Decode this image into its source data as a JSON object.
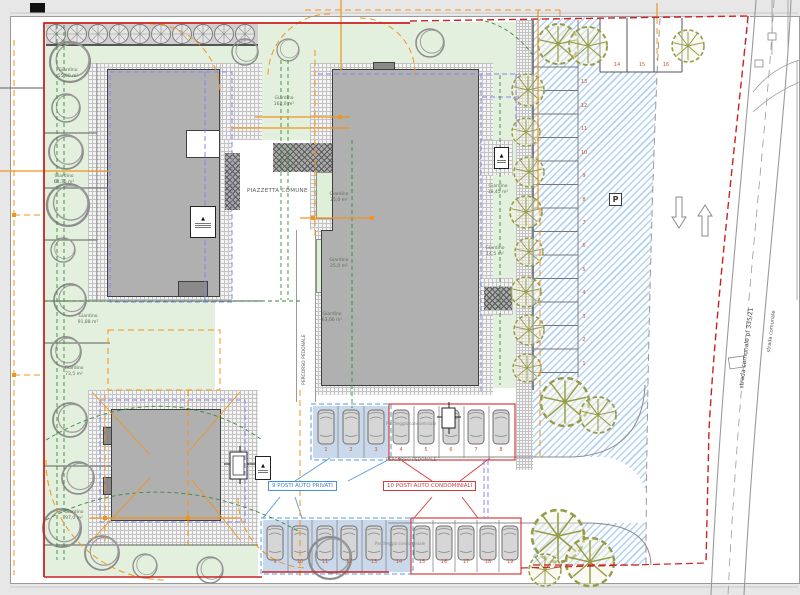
{
  "labels": {
    "piazzetta": "PIAZZETTA COMUNE",
    "percorso_pedonale_vertical": "PERCORSO PEDONALE",
    "percorso_pedonale_horizontal": "PERCORSO PEDONALE",
    "parcheggio_condominiale_mid": "Parcheggio condominiale",
    "parcheggio_condominiale_bottom": "Parcheggio condominiale",
    "posti_privati": "9 POSTI AUTO PRIVATI",
    "posti_condominiali": "10 POSTI AUTO CONDOMINIALI",
    "street_name": "strada comunale pf 335/21",
    "street_name_2": "strada comunale",
    "parking_sign": "P"
  },
  "gardens": {
    "g1": {
      "name": "Giardino",
      "area": "55,00 m²"
    },
    "g2": {
      "name": "Giardino",
      "area": "64,75 m²"
    },
    "g3": {
      "name": "Giardino",
      "area": "162,0 m²"
    },
    "g4": {
      "name": "Giardino",
      "area": "25,0 m²"
    },
    "g5": {
      "name": "Giardino",
      "area": "25,0 m²"
    },
    "g6": {
      "name": "Giardino",
      "area": "18,45 m²"
    },
    "g7": {
      "name": "Giardino",
      "area": "14,5 m²"
    },
    "g8": {
      "name": "Giardino",
      "area": "63,06 m²"
    },
    "g9": {
      "name": "Giardino",
      "area": "91,88 m²"
    },
    "g10": {
      "name": "Giardino",
      "area": "73,5 m²"
    },
    "g11": {
      "name": "Giardino",
      "area": "97,0 m²"
    }
  },
  "parking": {
    "right_column_stalls": [
      "1",
      "2",
      "3",
      "4",
      "5",
      "6",
      "7",
      "8",
      "9",
      "10",
      "11",
      "12",
      "13"
    ],
    "top_stalls": [
      "14",
      "15",
      "16"
    ],
    "middle_private": [
      "1",
      "2",
      "3"
    ],
    "middle_condo": [
      "4",
      "5",
      "6",
      "7",
      "8"
    ],
    "bottom_private": [
      "9",
      "10",
      "11",
      "12",
      "13",
      "14"
    ],
    "bottom_condo": [
      "15",
      "16",
      "17",
      "18",
      "19"
    ]
  },
  "colors": {
    "boundary_red": "#cc2222",
    "dimension_orange": "#f0941e",
    "hedge_green": "#3a8a3a",
    "setback_blue": "#8585ef",
    "hatch_blue": "#b5d2ee",
    "private_label_blue": "#4a90d9",
    "condo_label_red": "#d43c3c",
    "stall_number": "#d4502d"
  }
}
